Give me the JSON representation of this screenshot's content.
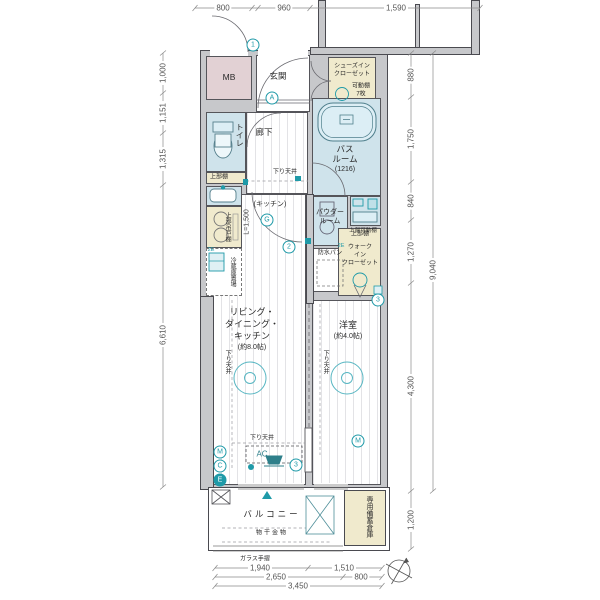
{
  "colors": {
    "wall_gray": "#c7c8cb",
    "outline": "#4a4a50",
    "wet_blue": "#cfe3eb",
    "closet_cream": "#f0eacd",
    "mb_pink": "#e2d1d4",
    "accent_teal": "#1f9aa8"
  },
  "labels": {
    "mb": "MB",
    "genkan": "玄関",
    "sic1": "シューズイン",
    "sic2": "クローゼット",
    "sic_shelf1": "可動棚",
    "sic_shelf2": "7枚",
    "toilet": "トイレ",
    "toilet_shelf": "上部棚",
    "hallway": "廊下",
    "bath1": "バス",
    "bath2": "ルーム",
    "bath3": "(1216)",
    "kitchen": "(キッチン)",
    "kitchen_len": "L=1,500",
    "kitchen_cab": "上部吊戸棚",
    "fridge": "冷蔵庫置場",
    "powder1": "パウダー",
    "powder2": "ルーム",
    "pan": "防水パン",
    "pan_shelf": "上部可動棚",
    "wic_shelf": "上部棚",
    "wic1": "ウォーク",
    "wic2": "イン",
    "wic3": "クローゼット",
    "ldk1": "リビング・",
    "ldk2": "ダイニング・",
    "ldk3": "キッチン",
    "ldk4": "(約8.0帖)",
    "bedroom": "洋室",
    "bedroom_size": "(約4.0帖)",
    "down_ceiling": "下り天井",
    "ac": "AC",
    "balcony": "バルコニー",
    "monohoshi": "物干金物",
    "glass_rail": "ガラス手摺",
    "storage": "専用備蓄倉庫",
    "outlet_2e": "2E"
  },
  "dims": {
    "top": [
      "800",
      "960",
      "1,590"
    ],
    "left": [
      "1,000",
      "1,151",
      "1,315",
      "6,610"
    ],
    "right": [
      "880",
      "1,750",
      "840",
      "1,270",
      "9,040",
      "4,300",
      "1,200"
    ],
    "bottom": [
      "1,940",
      "1,510",
      "2,650",
      "800",
      "3,450"
    ]
  },
  "markers": {
    "m1": "1",
    "mA": "A",
    "mG": "G",
    "m2": "2",
    "m3wic": "3",
    "m3ac": "3",
    "mM_ldk": "M",
    "mC_ldk": "C",
    "mE_ldk": "E",
    "mM_bed": "M"
  }
}
